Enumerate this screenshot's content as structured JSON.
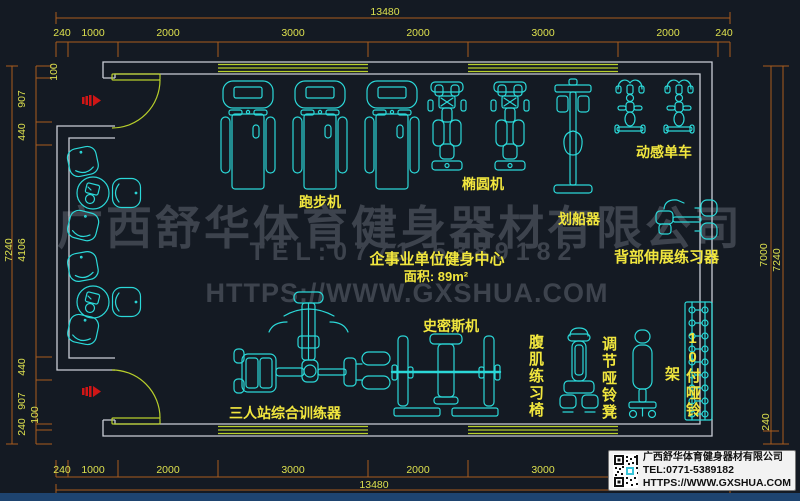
{
  "watermark": {
    "company": "广西舒华体育健身器材有限公司",
    "tel": "TEL:0771-5389182",
    "url": "HTTPS://WWW.GXSHUA.COM"
  },
  "room": {
    "title": "企事业单位健身中心",
    "area": "面积: 89m²"
  },
  "equipment": {
    "treadmill": "跑步机",
    "elliptical": "椭圆机",
    "rower": "划船器",
    "spin_bike": "动感单车",
    "back_extension": "背部伸展练习器",
    "smith_machine": "史密斯机",
    "ab_chair": "腹肌练习椅",
    "dumbbell_bench": "调节哑铃凳",
    "dumbbell_rack": "10付哑铃架",
    "multi_station": "三人站综合训练器"
  },
  "dimensions": {
    "top": {
      "total": "13480",
      "segments": [
        "240",
        "1000",
        "2000",
        "3000",
        "2000",
        "3000",
        "2000",
        "240"
      ]
    },
    "bottom": {
      "total": "13480",
      "segments": [
        "240",
        "1000",
        "2000",
        "3000",
        "2000",
        "3000",
        "2000",
        "240"
      ]
    },
    "left": {
      "total": "7240",
      "segments": [
        "100",
        "907",
        "440",
        "4106",
        "440",
        "907",
        "100",
        "240"
      ]
    },
    "right": {
      "inner_total": "7000",
      "outer_total": "7240",
      "wall": "240"
    }
  },
  "info_box": {
    "company": "广西舒华体育健身器材有限公司",
    "tel": "TEL:0771-5389182",
    "url": "HTTPS://WWW.GXSHUA.COM"
  },
  "colors": {
    "background": "#141a23",
    "equipment": "#2bd8d8",
    "walls": "#c9ced6",
    "dimension_lines": "#aa5c1e",
    "dimension_text": "#dde04e",
    "labels": "#f2e73e",
    "windows_doors": "#b8cf2b",
    "watermark": "#3d434d",
    "door_marker": "#d01616",
    "bottom_bar": "#1e4470"
  }
}
